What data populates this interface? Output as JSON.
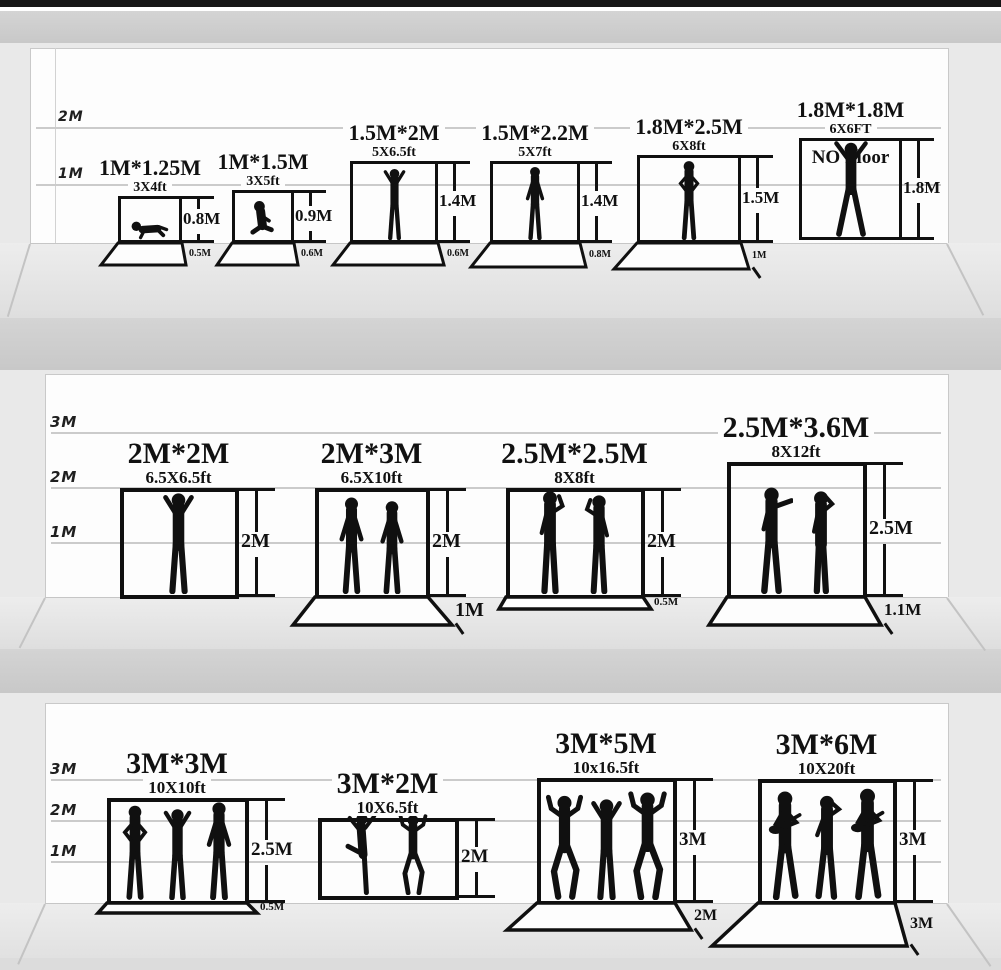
{
  "colors": {
    "silhouette": "#101010",
    "frame": "#101010",
    "divider_band": "#cdcdcd",
    "wall": "#fdfdfd",
    "floor": "#e7e7e7"
  },
  "shelves": [
    {
      "axis_labels": [
        "2M",
        "1M"
      ],
      "items": [
        {
          "title": "1M*1.25M",
          "subtitle": "3X4ft",
          "height_label": "0.8M",
          "floor_label": "0.5M",
          "people": [
            "baby"
          ]
        },
        {
          "title": "1M*1.5M",
          "subtitle": "3X5ft",
          "height_label": "0.9M",
          "floor_label": "0.6M",
          "people": [
            "toddler"
          ]
        },
        {
          "title": "1.5M*2M",
          "subtitle": "5X6.5ft",
          "height_label": "1.4M",
          "floor_label": "0.6M",
          "people": [
            "victory"
          ]
        },
        {
          "title": "1.5M*2.2M",
          "subtitle": "5X7ft",
          "height_label": "1.4M",
          "floor_label": "0.8M",
          "people": [
            "stand"
          ]
        },
        {
          "title": "1.8M*2.5M",
          "subtitle": "6X8ft",
          "height_label": "1.5M",
          "floor_label": "1M",
          "people": [
            "hips"
          ]
        },
        {
          "title": "1.8M*1.8M",
          "subtitle": "6X6FT",
          "height_label": "1.8M",
          "note": "NO Floor",
          "people": [
            "spread"
          ]
        }
      ]
    },
    {
      "axis_labels": [
        "3M",
        "2M",
        "1M"
      ],
      "items": [
        {
          "title": "2M*2M",
          "subtitle": "6.5X6.5ft",
          "height_label": "2M",
          "people": [
            "victory"
          ]
        },
        {
          "title": "2M*3M",
          "subtitle": "6.5X10ft",
          "height_label": "2M",
          "floor_label": "1M",
          "people": [
            "stand",
            "stand"
          ]
        },
        {
          "title": "2.5M*2.5M",
          "subtitle": "8X8ft",
          "height_label": "2M",
          "floor_label": "0.5M",
          "people": [
            "talkR",
            "talkL"
          ]
        },
        {
          "title": "2.5M*3.6M",
          "subtitle": "8X12ft",
          "height_label": "2.5M",
          "floor_label": "1.1M",
          "people": [
            "point",
            "phone"
          ]
        }
      ]
    },
    {
      "axis_labels": [
        "3M",
        "2M",
        "1M"
      ],
      "items": [
        {
          "title": "3M*3M",
          "subtitle": "10X10ft",
          "height_label": "2.5M",
          "floor_label": "0.5M",
          "people": [
            "hips",
            "victory",
            "stand"
          ]
        },
        {
          "title": "3M*2M",
          "subtitle": "10X6.5ft",
          "height_label": "2M",
          "people": [
            "kick",
            "danceup"
          ]
        },
        {
          "title": "3M*5M",
          "subtitle": "10x16.5ft",
          "height_label": "3M",
          "floor_label": "2M",
          "people": [
            "danceup",
            "victory",
            "danceup"
          ]
        },
        {
          "title": "3M*6M",
          "subtitle": "10X20ft",
          "height_label": "3M",
          "floor_label": "3M",
          "people": [
            "guitar",
            "sing",
            "guitar"
          ]
        }
      ]
    }
  ]
}
